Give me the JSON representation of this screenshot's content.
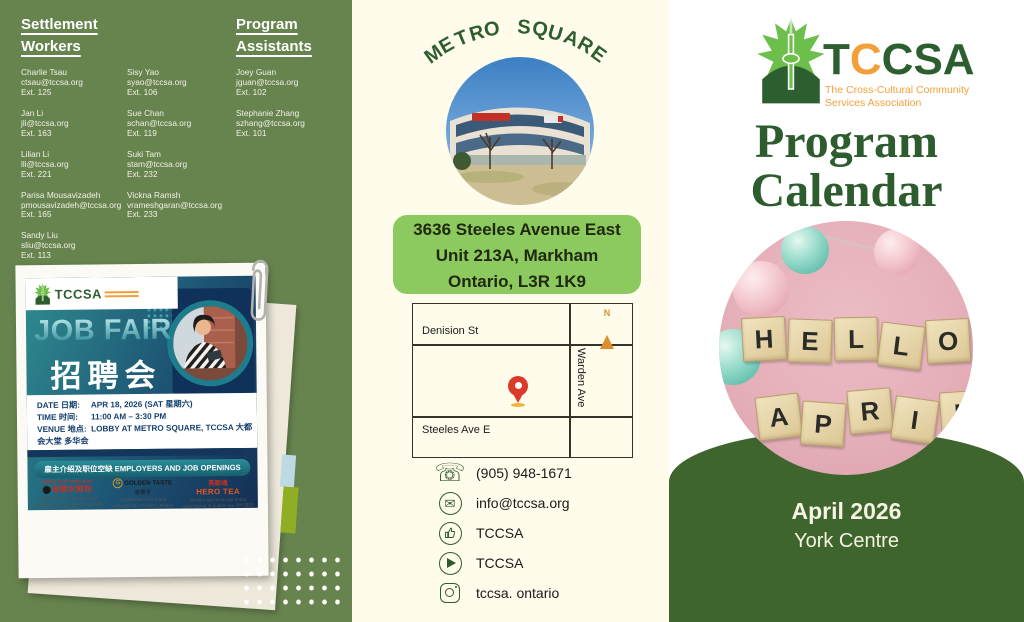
{
  "left_panel": {
    "settlement_heading": {
      "line1": "Settlement",
      "line2": "Workers"
    },
    "program_heading": {
      "line1": "Program",
      "line2": "Assistants"
    },
    "settlement_workers_col1": [
      {
        "name": "Charlie Tsau",
        "email": "ctsau@tccsa.org",
        "ext": "Ext. 125"
      },
      {
        "name": "Jan Li",
        "email": "jli@tccsa.org",
        "ext": "Ext. 163"
      },
      {
        "name": "Lilian Li",
        "email": "lli@tccsa.org",
        "ext": "Ext. 221"
      },
      {
        "name": "Parisa Mousavizadeh",
        "email": "pmousavizadeh@tccsa.org",
        "ext": "Ext. 165"
      },
      {
        "name": "Sandy Liu",
        "email": "sliu@tccsa.org",
        "ext": "Ext. 113"
      }
    ],
    "settlement_workers_col2": [
      {
        "name": "Sisy Yao",
        "email": "syao@tccsa.org",
        "ext": "Ext. 106"
      },
      {
        "name": "Sue Chan",
        "email": "schan@tccsa.org",
        "ext": "Ext. 119"
      },
      {
        "name": "Suki Tam",
        "email": "stam@tccsa.org",
        "ext": "Ext. 232"
      },
      {
        "name": "Vickna Ramsh",
        "email": "vrameshgaran@tccsa.org",
        "ext": "Ext. 233"
      }
    ],
    "program_assistants": [
      {
        "name": "Joey Guan",
        "email": "jguan@tccsa.org",
        "ext": "Ext. 102"
      },
      {
        "name": "Stephanie Zhang",
        "email": "szhang@tccsa.org",
        "ext": "Ext. 101"
      }
    ],
    "flyer": {
      "logo_text": "TCCSA",
      "title_en": "JOB FAIR",
      "title_zh": "招聘会",
      "date_label": "DATE 日期:",
      "date_value": "APR 18, 2026 (SAT 星期六)",
      "time_label": "TIME 时间:",
      "time_value": "11:00 AM – 3:30 PM",
      "venue_label": "VENUE 地点:",
      "venue_line1": "LOBBY AT METRO SQUARE, TCCSA 大都会大堂 多华会",
      "venue_line2": "3636 STEELES AVE E, MARKHAM, ON L3R 1K9",
      "banner": "雇主介绍及职位空缺 EMPLOYERS AND JOB OPENINGS",
      "employer1": {
        "brand": "MOM'S PAN FRIED BUN",
        "name": "老娘水煎包",
        "desc": "Canada's first restaurant brand specializing in pan-fried buns 加拿大第一间水煎包专门店"
      },
      "employer2": {
        "brand": "GOLDEN TASTE",
        "name": "金筷子",
        "desc": "Established food brand specializing in frozen Chinese foods 知名食品品牌，专营冷冻中式食品"
      },
      "employer3": {
        "brand": "HERO TEA",
        "name": "英歌魂",
        "desc": "Modern tea beverage brand specializing in bubble tea 现代茶饮品牌"
      }
    }
  },
  "middle_panel": {
    "location_title": "METRO SQUARE",
    "address": {
      "line1": "3636 Steeles Avenue East",
      "line2": "Unit 213A, Markham",
      "line3": "Ontario, L3R 1K9"
    },
    "map": {
      "street_top": "Denision St",
      "street_right": "Warden Ave",
      "street_bottom": "Steeles Ave E",
      "compass": "N"
    },
    "contacts": {
      "phone": "(905) 948-1671",
      "email": "info@tccsa.org",
      "facebook": "TCCSA",
      "youtube": "TCCSA",
      "instagram": "tccsa. ontario"
    }
  },
  "right_panel": {
    "logo": {
      "wordmark_t": "T",
      "wordmark_c": "C",
      "wordmark_rest": "CSA",
      "tagline_line1": "The Cross-Cultural Community",
      "tagline_line2": "Services Association"
    },
    "title": {
      "line1": "Program",
      "line2": "Calendar"
    },
    "photo_words": {
      "row1": "HELLO",
      "row2": "APRIL"
    },
    "month": "April 2026",
    "location": "York Centre"
  },
  "colors": {
    "left_panel_green": "#67834e",
    "dome_green": "#3e652d",
    "dark_green_text": "#2d5e2f",
    "cream": "#fffcec",
    "accent_orange": "#f4a03a",
    "address_box_green": "#8cc95e",
    "flyer_navy": "#14355c",
    "flyer_teal": "#1d7d8c",
    "pin_red": "#d93a2b"
  }
}
